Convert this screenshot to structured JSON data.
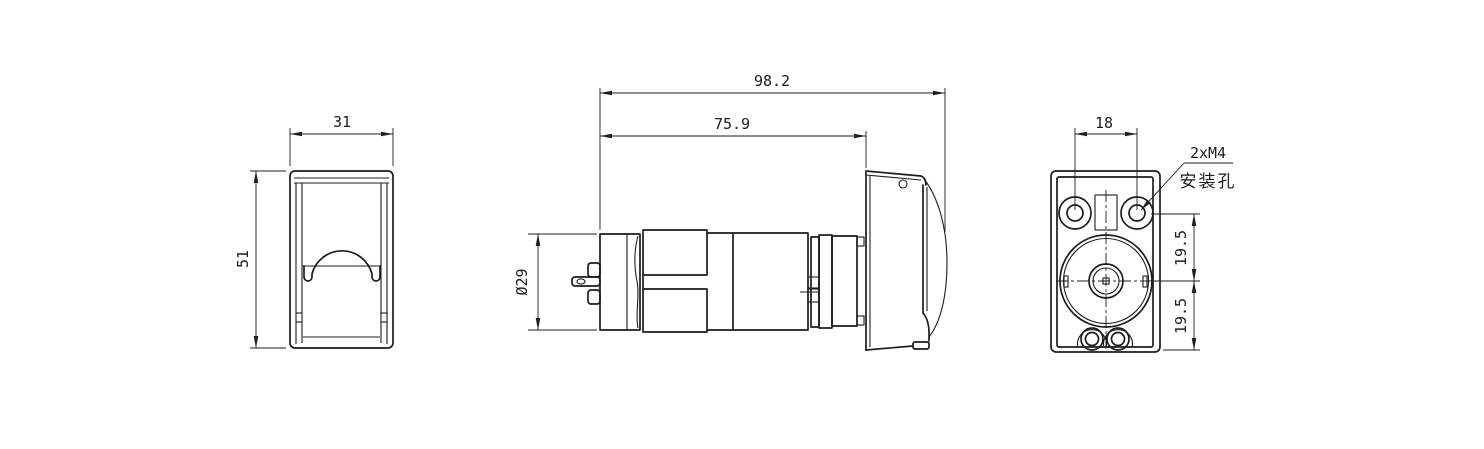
{
  "drawing": {
    "background_color": "#ffffff",
    "line_color": "#1d1d1d",
    "views": {
      "front": {
        "width_dim": "31",
        "height_dim": "51"
      },
      "side": {
        "overall_length_dim": "98.2",
        "body_length_dim": "75.9",
        "motor_diameter_dim": "Ø29"
      },
      "rear": {
        "hole_spacing_dim": "18",
        "mounting_note_line1": "2xM4",
        "mounting_note_line2": "安装孔",
        "upper_offset_dim": "19.5",
        "lower_offset_dim": "19.5"
      }
    }
  }
}
